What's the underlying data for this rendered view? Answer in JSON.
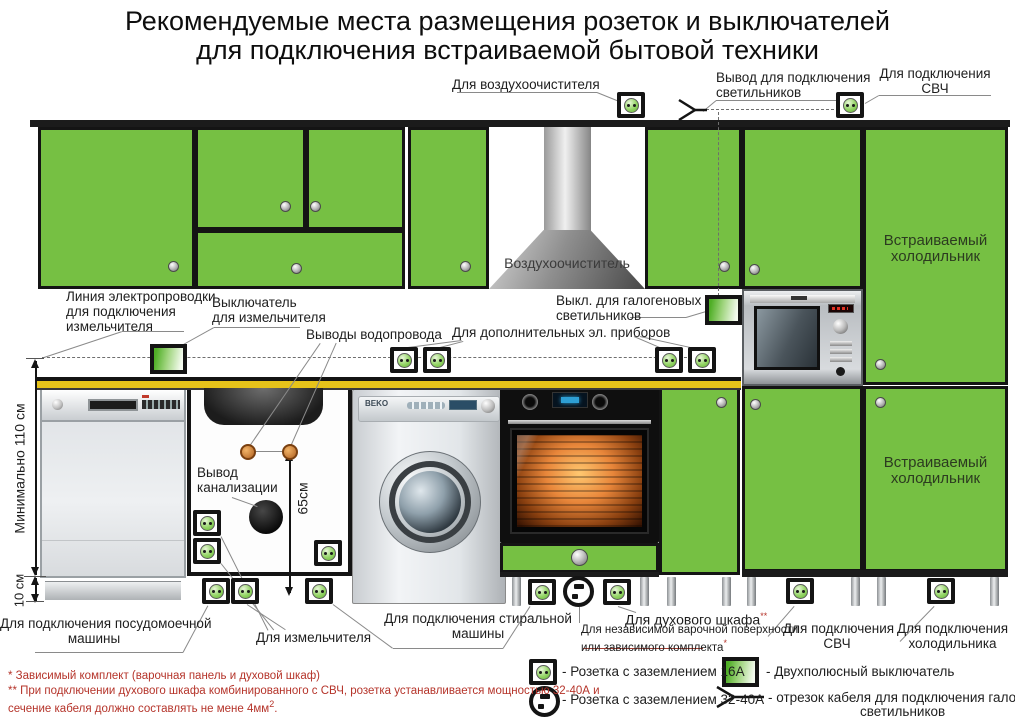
{
  "title": {
    "line1": "Рекомендуемые места размещения розеток и выключателей",
    "line2": "для подключения встраиваемой бытовой техники"
  },
  "top_labels": {
    "air_purifier": "Для воздухоочистителя",
    "lights_line1": "Вывод для подключения",
    "lights_line2": "светильников",
    "microwave_line1": "Для подключения",
    "microwave_line2": "СВЧ"
  },
  "mid_labels": {
    "wiring_line1": "Линия электропроводки",
    "wiring_line2": "для подключения",
    "wiring_line3": "измельчителя",
    "grinder_switch_line1": "Выключатель",
    "grinder_switch_line2": "для измельчителя",
    "water_outlets": "Выводы водопровода",
    "additional": "Для дополнительных эл. приборов",
    "halogen_line1": "Выкл. для галогеновых",
    "halogen_line2": "светильников",
    "sewer_line1": "Вывод",
    "sewer_line2": "канализации"
  },
  "cabinet_labels": {
    "hood": "Воздухоочиститель",
    "fridge_line1": "Встраиваемый",
    "fridge_line2": "холодильник"
  },
  "appliances": {
    "washer_brand": "BEKO"
  },
  "dimensions": {
    "height_min": "Минимально 110 см",
    "plinth": "10 см",
    "valves": "65см"
  },
  "bottom_labels": {
    "dishwasher_line1": "Для подключения посудомоечной",
    "dishwasher_line2": "машины",
    "grinder": "Для измельчителя",
    "washer_line1": "Для подключения стиральной",
    "washer_line2": "машины",
    "oven": "Для духового шкафа",
    "oven_mark": "**",
    "hob_line1": "Для независимой варочной поверхности",
    "hob_line2": "или зависимого комплекта",
    "hob_mark": "*",
    "microwave_line1": "Для подключения",
    "microwave_line2": "СВЧ",
    "fridge_line1": "Для подключения",
    "fridge_line2": "холодильника"
  },
  "footnotes": {
    "f1": "* Зависимый комплект (варочная панель и духовой шкаф)",
    "f2_line1": "** При подключении духового шкафа комбинированного с СВЧ, розетка устанавливается мощностью 32-40А и",
    "f2_line2": "сечение кабеля должно составлять не мене 4мм",
    "f2_sup": "2",
    "f2_end": "."
  },
  "legend": {
    "socket16": "- Розетка с заземлением 16А",
    "switch": "- Двухполюсный выключатель",
    "socket3240": "- Розетка с заземлением 32-40А",
    "cable_line1": "- отрезок кабеля для подключения галогеновых",
    "cable_line2": "светильников"
  },
  "colors": {
    "cabinet_green": "#76c043",
    "countertop_yellow": "#e6c31a",
    "note_red": "#b5342a",
    "outline_black": "#141414"
  }
}
